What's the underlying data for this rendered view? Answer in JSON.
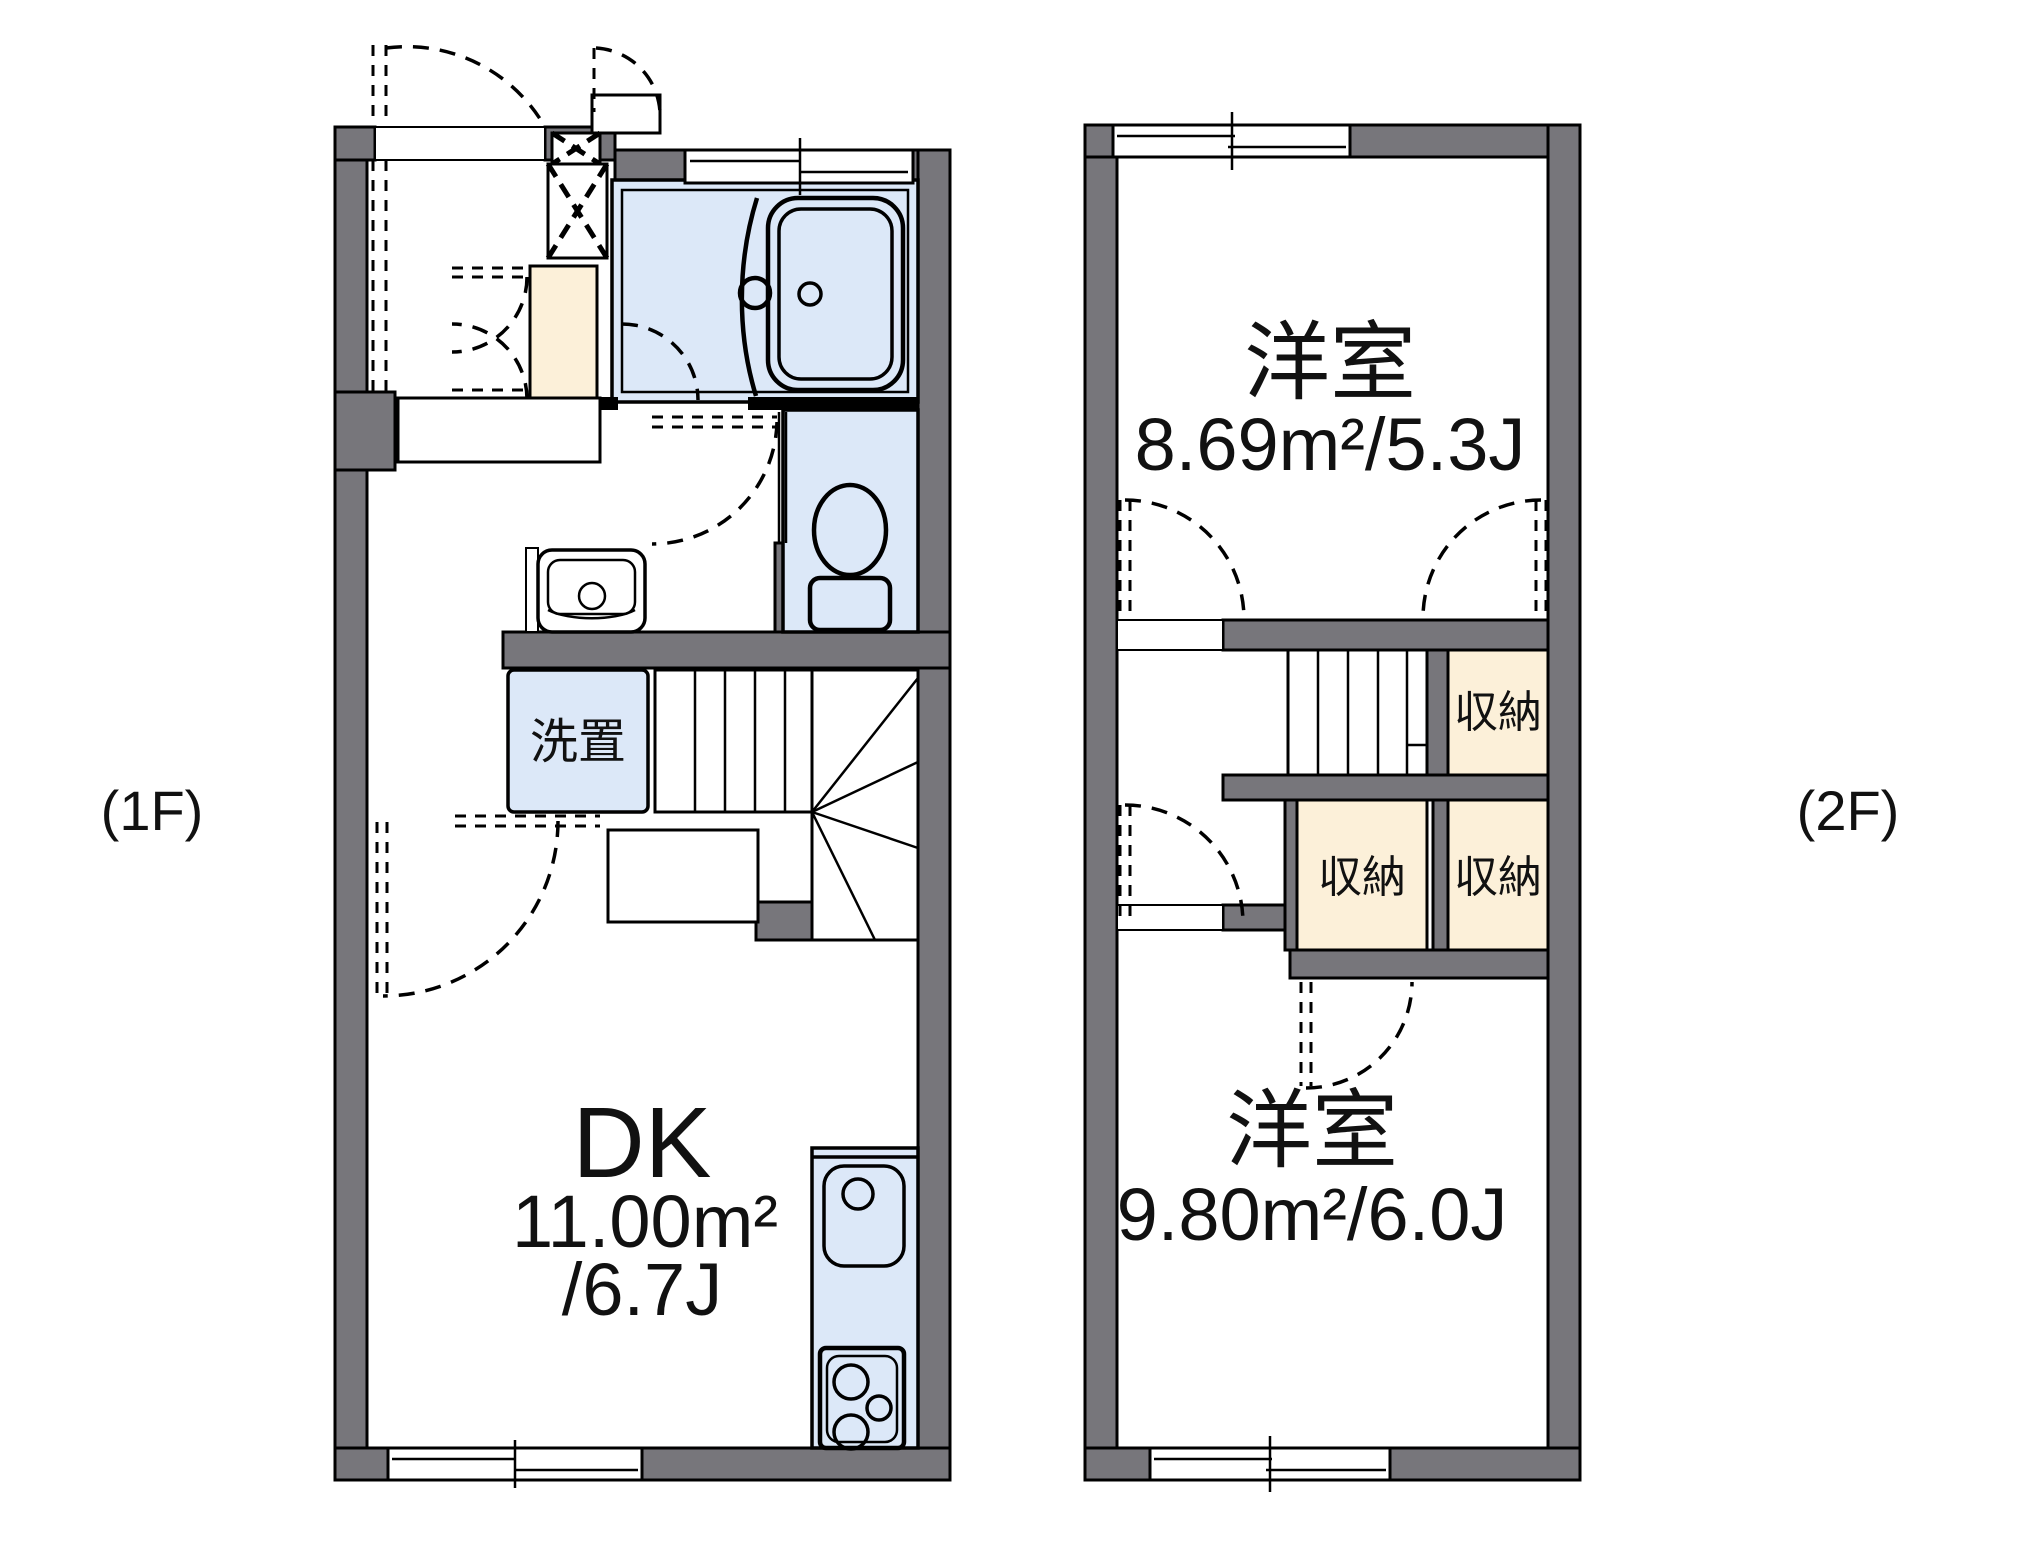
{
  "colors": {
    "wall": "#77767b",
    "room_blue": "#dce8f8",
    "closet_cream": "#fcf0d9",
    "line": "#000000",
    "background": "#ffffff"
  },
  "floor_plans": {
    "floor1": {
      "label": "(1F)",
      "rooms": {
        "dk": {
          "name": "DK",
          "area": "11.00m²",
          "tatami": "/6.7J"
        },
        "laundry": {
          "label": "洗置"
        }
      }
    },
    "floor2": {
      "label": "(2F)",
      "rooms": {
        "bedroom_top": {
          "name": "洋室",
          "area": "8.69m²/5.3J"
        },
        "bedroom_bottom": {
          "name": "洋室",
          "area": "9.80m²/6.0J"
        },
        "closet_top": {
          "label": "収納"
        },
        "closet_mid": {
          "label": "収納"
        },
        "closet_right": {
          "label": "収納"
        }
      }
    }
  }
}
